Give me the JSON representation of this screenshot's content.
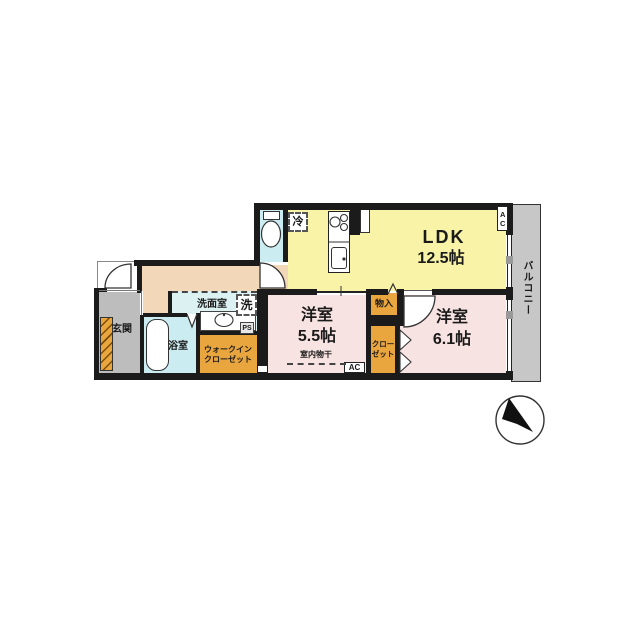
{
  "plan": {
    "ldk": {
      "name": "LDK",
      "area": "12.5帖"
    },
    "bedroom1": {
      "name": "洋室",
      "area": "5.5帖"
    },
    "bedroom2": {
      "name": "洋室",
      "area": "6.1帖"
    },
    "washroom": {
      "label": "洗面室"
    },
    "bathroom": {
      "label": "浴室"
    },
    "entrance": {
      "label": "玄関"
    },
    "balcony": {
      "label": "バルコニー"
    },
    "walk_in_closet": {
      "line1": "ウォークイン",
      "line2": "クローゼット"
    },
    "closet": {
      "line1": "クロー",
      "line2": "ゼット"
    },
    "storage": {
      "label": "物入"
    },
    "indoor_drying": {
      "label": "室内物干"
    },
    "fridge": {
      "label": "冷"
    },
    "washer": {
      "label": "洗"
    },
    "pipe_space": {
      "label": "PS"
    },
    "ac_top": {
      "label": "AC"
    },
    "ac_bottom": {
      "label": "AC"
    }
  },
  "colors": {
    "ldk_yellow": "#F8F3A6",
    "bedroom_pink": "#F7E3E1",
    "hall_peach": "#F3D7B9",
    "wet_cyan": "#CBEDF2",
    "washroom_cyan": "#DCF2F2",
    "storage_orange": "#E9A53E",
    "entrance_gray": "#BDBDBD",
    "balcony_gray": "#C7C7C7",
    "wall": "#1B1B1B"
  }
}
